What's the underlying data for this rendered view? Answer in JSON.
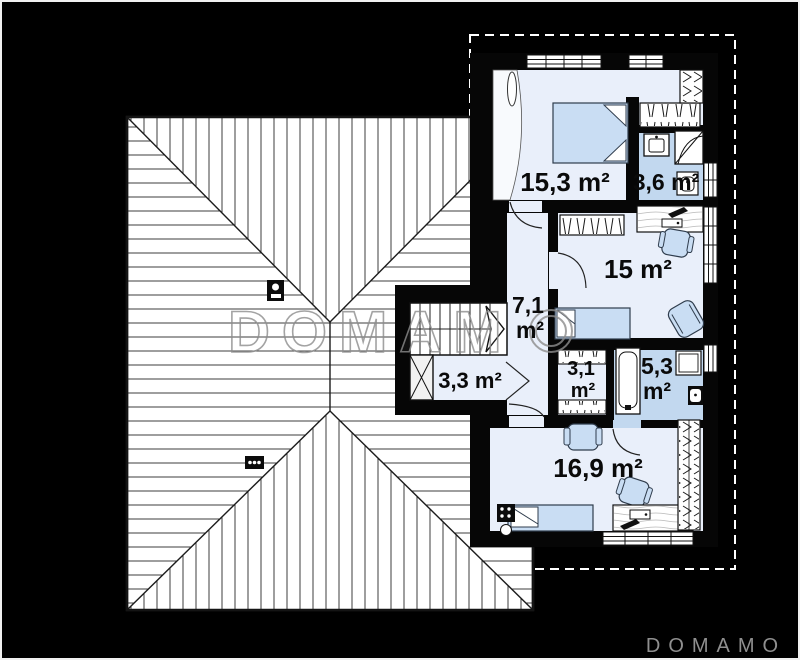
{
  "plan": {
    "type": "second-floor house plan with roof view",
    "rooms": {
      "bedroom_top": {
        "area": "15,3 m²"
      },
      "bathroom_top": {
        "area": "3,6 m²"
      },
      "room_middle": {
        "area": "15 m²"
      },
      "hall": {
        "value": "7,1",
        "unit": "m²"
      },
      "stair_landing": {
        "area": "3,3 m²"
      },
      "wardrobe_room": {
        "value": "3,1",
        "unit": "m²"
      },
      "bathroom_bottom": {
        "value": "5,3",
        "unit": "m²"
      },
      "bedroom_bottom": {
        "area": "16,9 m²"
      }
    },
    "icons": [
      "double-bed",
      "single-bed",
      "wardrobe-hatch",
      "closet-hangers",
      "sink",
      "corner-shower",
      "toilet",
      "bathtub",
      "washing-machine",
      "desk",
      "desk-lamp",
      "keyboard",
      "office-chair",
      "armchair",
      "stairs-with-arrow",
      "void-x-box",
      "chimney",
      "roof-vent",
      "radiator",
      "stove-heater",
      "window",
      "door-arc"
    ],
    "colors": {
      "background": "#000000",
      "roof_fill": "#ffffff",
      "floor": "#e9effa",
      "wet_room_floor": "#c2d8ef",
      "furniture_fill": "#c9ddf3",
      "wall": "#060606",
      "watermark_gray": "#8d8d8d",
      "dashed_outline": "#ffffff"
    }
  },
  "watermark": {
    "text": "DOMAMO",
    "letters": "DOMAM"
  },
  "brand": {
    "text": "DOMAMO"
  }
}
